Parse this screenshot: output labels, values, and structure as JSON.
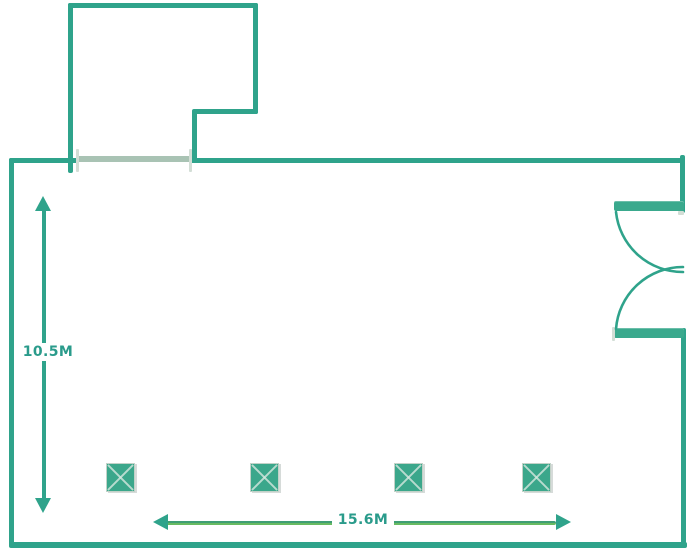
{
  "floorplan": {
    "title": "floor-plan",
    "height_dimension_label": "10.5M",
    "width_dimension_label": "15.6M",
    "columns": {
      "count": 4,
      "positions_x": [
        106,
        250,
        394,
        522
      ],
      "y": 463,
      "size": 29
    },
    "door": {
      "name": "double-swing-door",
      "wall": "right"
    },
    "opening": {
      "name": "wall-opening",
      "wall": "top-left"
    },
    "colors": {
      "wall": "#2fa38b",
      "door_leaf": "#3aa98d",
      "opening": "#a9c3b4",
      "tick": "#d3ded6",
      "column_fill": "#3ba78b",
      "column_border": "#c2d2c8",
      "column_cross": "#d8e8e0",
      "dim_teal": "#2fa38b",
      "dim_line_top": "#3f9e74",
      "dim_line_bottom": "#68ba62",
      "label_text": "#2a9b8b",
      "background": "#ffffff"
    }
  }
}
